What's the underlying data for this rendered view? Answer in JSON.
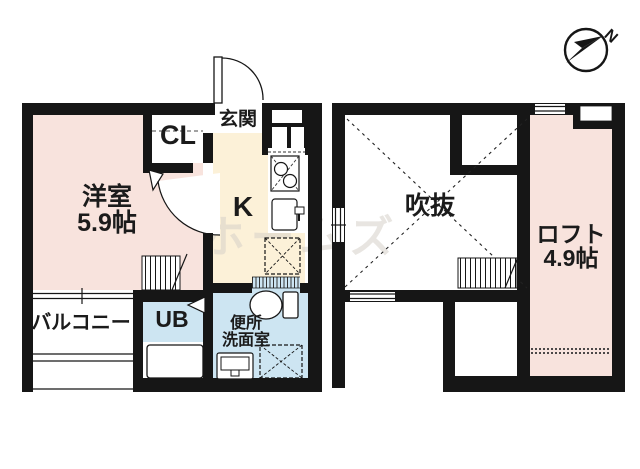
{
  "compass": {
    "north_label": "N"
  },
  "watermark": {
    "text": "ホームズ"
  },
  "floor1": {
    "living_room": {
      "name": "洋室",
      "size": "5.9帖"
    },
    "closet": {
      "label": "CL"
    },
    "entrance": {
      "label": "玄関"
    },
    "kitchen": {
      "label": "K"
    },
    "balcony": {
      "label": "バルコニー"
    },
    "unit_bath": {
      "label": "UB"
    },
    "washroom": {
      "line1": "便所",
      "line2": "洗面室"
    }
  },
  "floor2": {
    "void": {
      "label": "吹抜"
    },
    "loft": {
      "name": "ロフト",
      "size": "4.9帖"
    }
  },
  "colors": {
    "room_pink": "#f8e3dd",
    "kitchen_beige": "#fcf1d8",
    "bath_blue": "#cde5f2",
    "wall_black": "#161616",
    "watermark_gray": "#d6d1c9"
  }
}
